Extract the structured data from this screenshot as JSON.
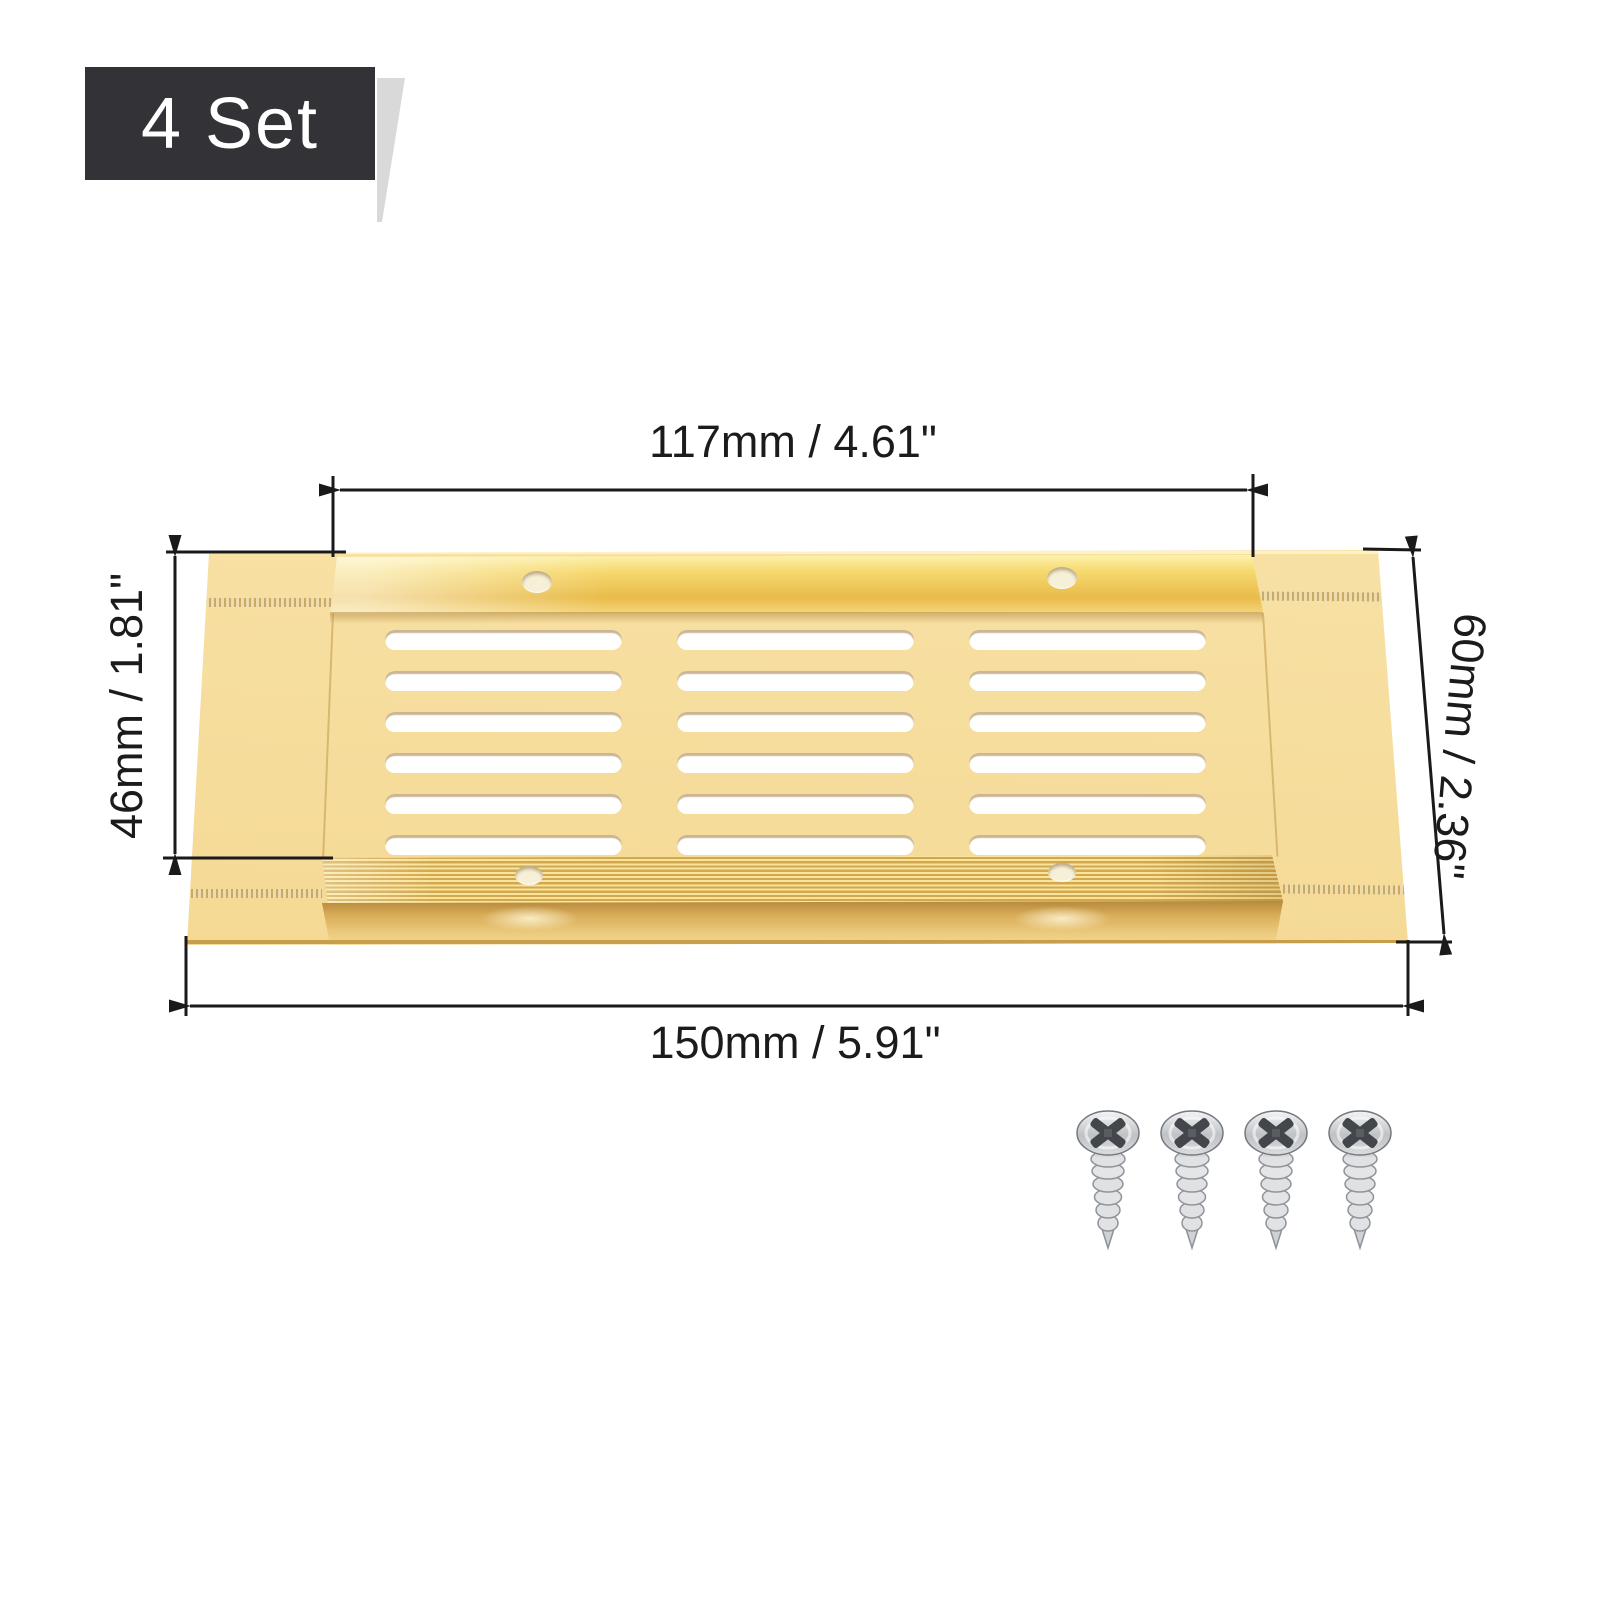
{
  "badge": {
    "label": "4 Set"
  },
  "product": {
    "type": "gold aluminum ventilation grille plate",
    "finish_color": "gold",
    "vents": {
      "rows": 6,
      "columns": 3
    },
    "screw_holes": 4
  },
  "dimensions": {
    "top": {
      "label": "117mm / 4.61\""
    },
    "left": {
      "label": "46mm / 1.81\""
    },
    "right": {
      "label": "60mm / 2.36\""
    },
    "bottom": {
      "label": "150mm / 5.91\""
    }
  },
  "hardware": {
    "screws_count": 4
  },
  "colors": {
    "badge_bg": "#333237",
    "ribbon_fold": "#d9d9d9",
    "gold_light": "#f8e2a8",
    "gold_mid": "#f2d285",
    "gold_deep": "#e2b052",
    "dimension_line": "#1a1a1a",
    "screw_metal": "#d7d9db"
  }
}
